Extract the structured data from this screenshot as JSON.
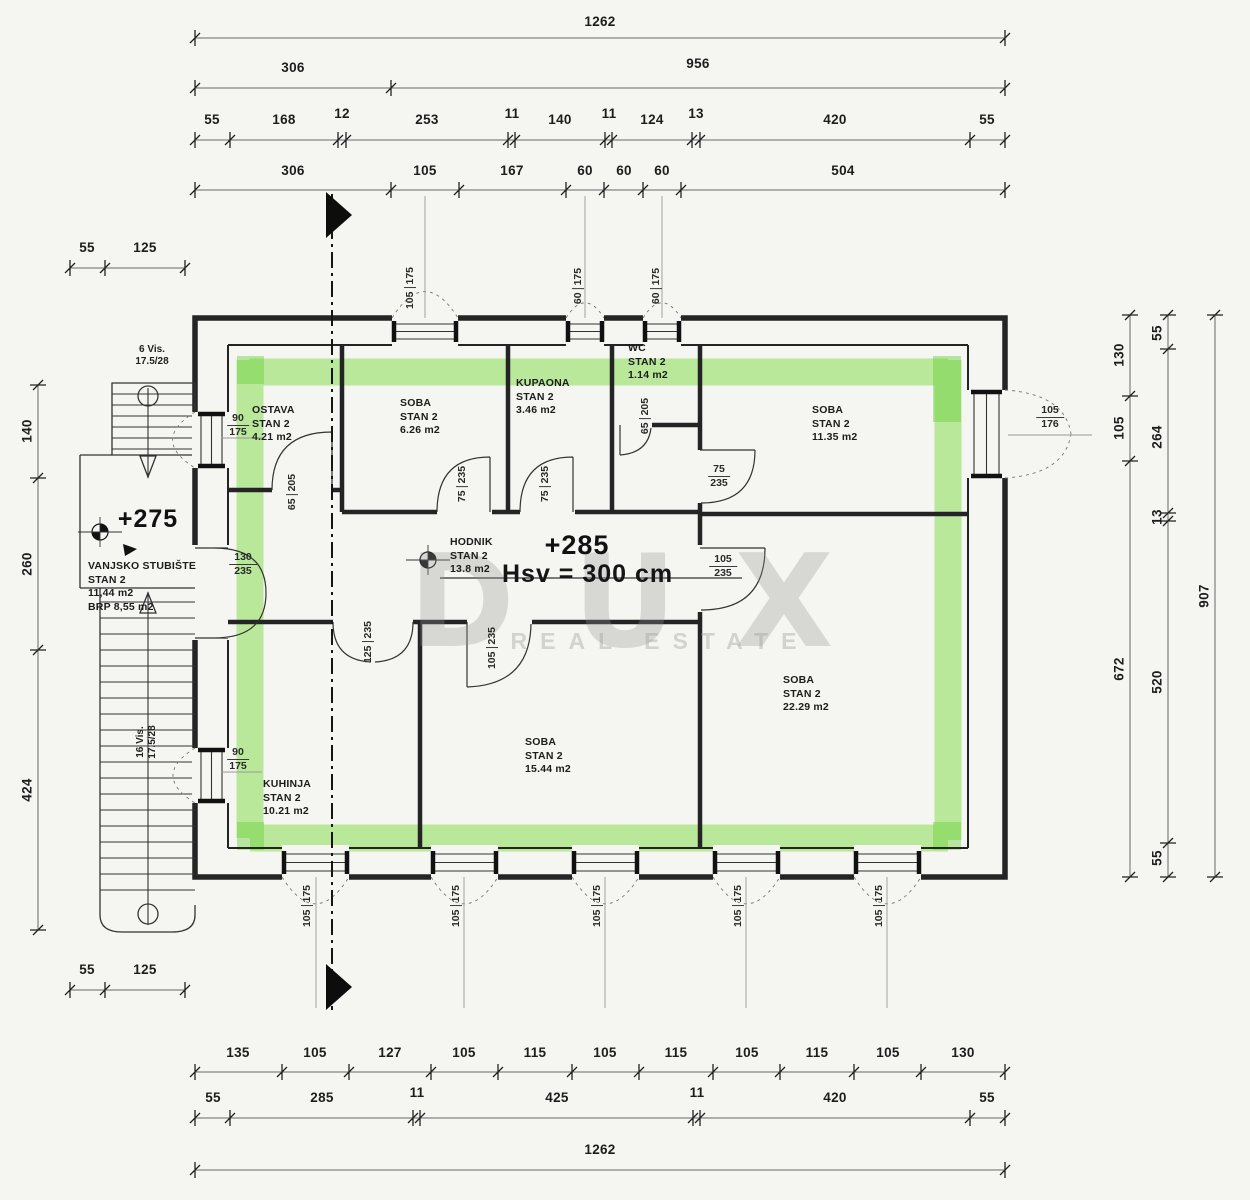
{
  "colors": {
    "highlight_green": "#7fdc45",
    "wall_black": "#242424",
    "paper": "#f5f5f1",
    "dim_line": "#666666"
  },
  "dims": {
    "t1": [
      "1262"
    ],
    "t2": [
      "306",
      "956"
    ],
    "t3": [
      "55",
      "168",
      "12",
      "253",
      "11",
      "140",
      "11",
      "124",
      "13",
      "420",
      "55"
    ],
    "t4": [
      "306",
      "105",
      "167",
      "60",
      "60",
      "60",
      "504"
    ],
    "lt": [
      "55",
      "125"
    ],
    "lv": [
      "140",
      "260",
      "424"
    ],
    "lb": [
      "55",
      "125"
    ],
    "r1": [
      "130",
      "105",
      "672"
    ],
    "r2": [
      "55",
      "264",
      "13",
      "520",
      "55"
    ],
    "r3": [
      "907"
    ],
    "b1": [
      "135",
      "105",
      "127",
      "105",
      "115",
      "105",
      "115",
      "105",
      "115",
      "105",
      "130"
    ],
    "b2": [
      "55",
      "285",
      "11",
      "425",
      "11",
      "420",
      "55"
    ],
    "b3": [
      "1262"
    ]
  },
  "openings": {
    "win_top": [
      [
        "105",
        "175"
      ],
      [
        "60",
        "175"
      ],
      [
        "60",
        "175"
      ]
    ],
    "win_bottom": [
      [
        "105",
        "175"
      ],
      [
        "105",
        "175"
      ],
      [
        "105",
        "175"
      ],
      [
        "105",
        "175"
      ],
      [
        "105",
        "175"
      ]
    ],
    "win_left": [
      [
        "90",
        "175"
      ],
      [
        "90",
        "175"
      ]
    ],
    "win_right": [
      [
        "105",
        "176"
      ]
    ],
    "door_ostava": [
      "65",
      "205"
    ],
    "door_soba1": [
      "75",
      "235"
    ],
    "door_kupaona": [
      "75",
      "235"
    ],
    "door_wc": [
      "65",
      "205"
    ],
    "door_soba2": [
      "75",
      "235"
    ],
    "door_entrance": [
      "130",
      "235"
    ],
    "door_soba3": [
      "105",
      "235"
    ],
    "door_soba4": [
      "105",
      "235"
    ],
    "door_kuhinja": [
      "125",
      "235"
    ]
  },
  "rooms": {
    "ostava": {
      "name": "OSTAVA",
      "unit": "STAN 2",
      "area": "4.21 m2"
    },
    "soba1": {
      "name": "SOBA",
      "unit": "STAN 2",
      "area": "6.26 m2"
    },
    "kupaona": {
      "name": "KUPAONA",
      "unit": "STAN 2",
      "area": "3.46 m2"
    },
    "wc": {
      "name": "WC",
      "unit": "STAN 2",
      "area": "1.14 m2"
    },
    "soba2": {
      "name": "SOBA",
      "unit": "STAN 2",
      "area": "11.35 m2"
    },
    "hodnik": {
      "name": "HODNIK",
      "unit": "STAN 2",
      "area": "13.8 m2"
    },
    "soba3": {
      "name": "SOBA",
      "unit": "STAN 2",
      "area": "22.29 m2"
    },
    "soba4": {
      "name": "SOBA",
      "unit": "STAN 2",
      "area": "15.44 m2"
    },
    "kuhinja": {
      "name": "KUHINJA",
      "unit": "STAN 2",
      "area": "10.21 m2"
    },
    "stubiste": {
      "name": "VANJSKO STUBIŠTE",
      "unit": "STAN 2",
      "area": "11,44 m2",
      "brp": "BRP 8,55  m2"
    }
  },
  "annotations": {
    "level_porch": "+275",
    "level_hodnik": "+285",
    "ceiling_height": "Hsv = 300 cm",
    "stairs_up": [
      "6 Vis.",
      "17.5/28"
    ],
    "stairs_down": [
      "16 Vis.",
      "17.5/28"
    ]
  },
  "watermark": {
    "main": "DUX",
    "sub": "REAL ESTATE"
  }
}
